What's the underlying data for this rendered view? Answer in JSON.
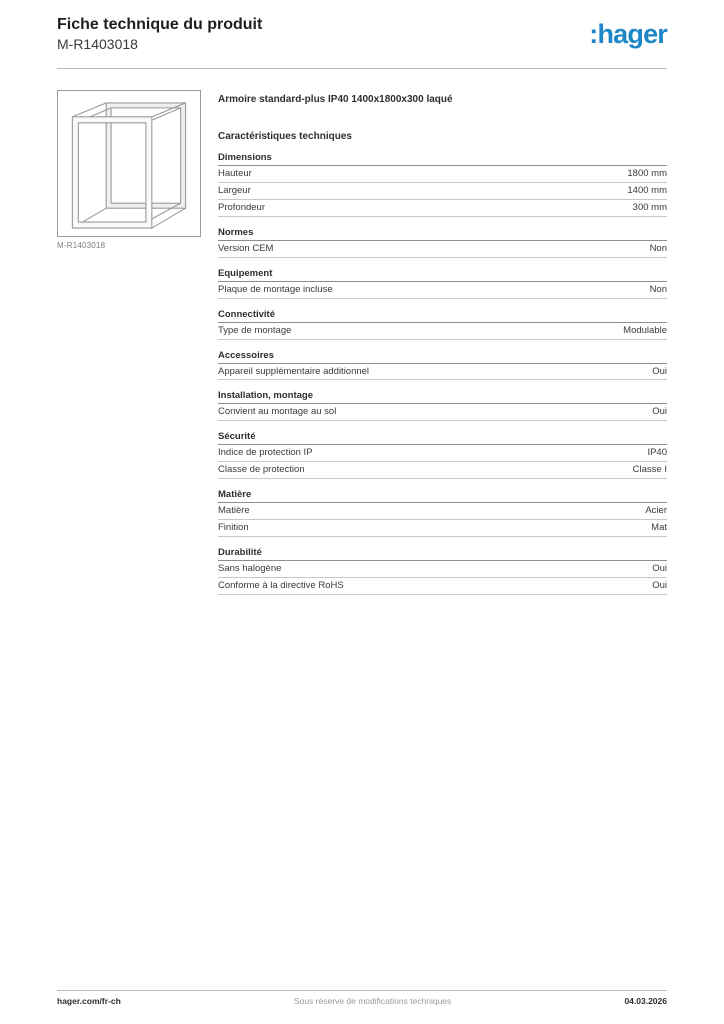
{
  "header": {
    "title": "Fiche technique du produit",
    "reference": "M-R1403018",
    "logo_text": ":hager",
    "brand_color": "#1e87c8"
  },
  "product": {
    "title": "Armoire standard-plus IP40 1400x1800x300 laqué",
    "image_caption": "M-R1403018",
    "image_description": "cabinet-frame-line-drawing"
  },
  "specs": {
    "heading": "Caractéristiques techniques",
    "sections": [
      {
        "title": "Dimensions",
        "rows": [
          {
            "label": "Hauteur",
            "value": "1800 mm"
          },
          {
            "label": "Largeur",
            "value": "1400 mm"
          },
          {
            "label": "Profondeur",
            "value": "300 mm"
          }
        ]
      },
      {
        "title": "Normes",
        "rows": [
          {
            "label": "Version CEM",
            "value": "Non"
          }
        ]
      },
      {
        "title": "Equipement",
        "rows": [
          {
            "label": "Plaque de montage incluse",
            "value": "Non"
          }
        ]
      },
      {
        "title": "Connectivité",
        "rows": [
          {
            "label": "Type de montage",
            "value": "Modulable"
          }
        ]
      },
      {
        "title": "Accessoires",
        "rows": [
          {
            "label": "Appareil supplémentaire additionnel",
            "value": "Oui"
          }
        ]
      },
      {
        "title": "Installation, montage",
        "rows": [
          {
            "label": "Convient au montage au sol",
            "value": "Oui"
          }
        ]
      },
      {
        "title": "Sécurité",
        "rows": [
          {
            "label": "Indice de protection IP",
            "value": "IP40"
          },
          {
            "label": "Classe de protection",
            "value": "Classe I"
          }
        ]
      },
      {
        "title": "Matière",
        "rows": [
          {
            "label": "Matière",
            "value": "Acier"
          },
          {
            "label": "Finition",
            "value": "Mat"
          }
        ]
      },
      {
        "title": "Durabilité",
        "rows": [
          {
            "label": "Sans halogène",
            "value": "Oui"
          },
          {
            "label": "Conforme à la directive RoHS",
            "value": "Oui"
          }
        ]
      }
    ]
  },
  "footer": {
    "website": "hager.com/fr-ch",
    "disclaimer": "Sous réserve de modifications techniques",
    "date": "04.03.2026"
  }
}
